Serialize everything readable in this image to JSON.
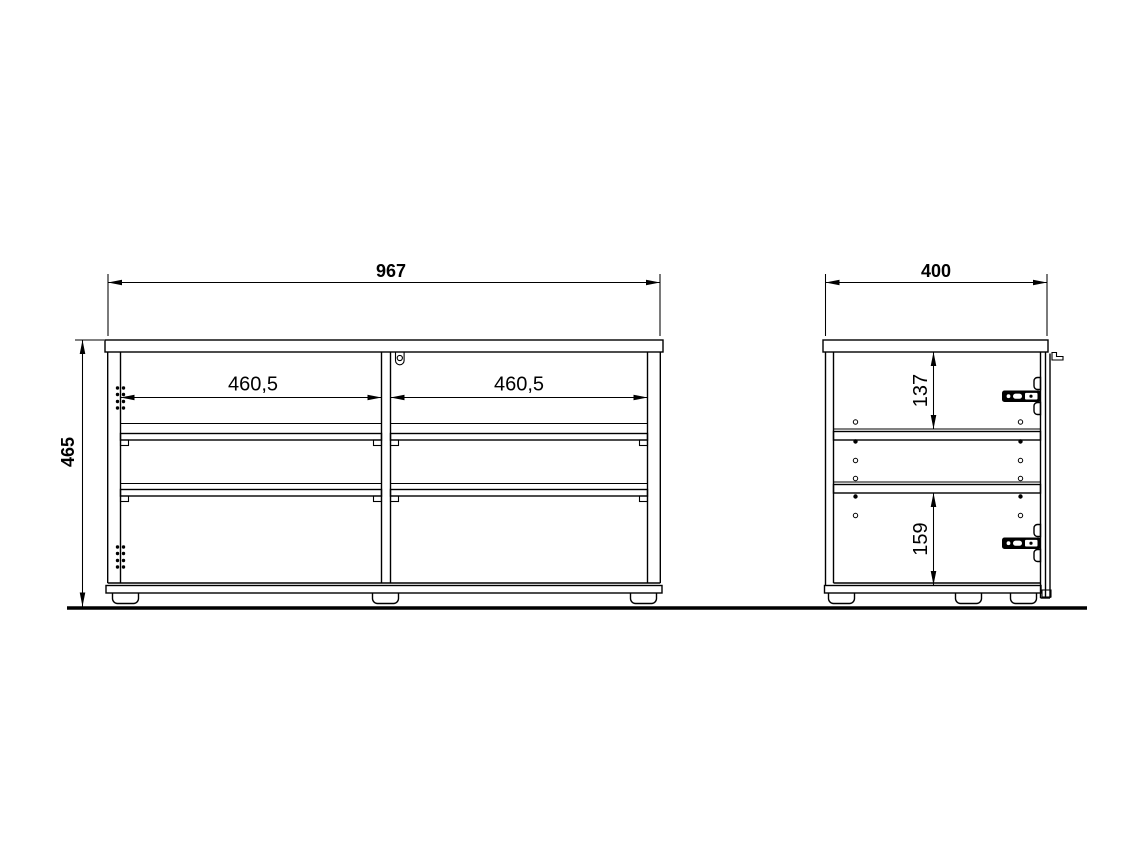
{
  "page": {
    "background_color": "#ffffff",
    "line_color": "#000000",
    "description": "Technical drawing of a cabinet: front elevation and side elevation with dimensions"
  },
  "views": {
    "front": {
      "dimensions": {
        "width": {
          "label": "967"
        },
        "height": {
          "label": "465"
        },
        "left_opening": {
          "label": "460,5"
        },
        "right_opening": {
          "label": "460,5"
        }
      }
    },
    "side": {
      "dimensions": {
        "depth": {
          "label": "400"
        },
        "upper_section": {
          "label": "137"
        },
        "lower_section": {
          "label": "159"
        }
      }
    }
  }
}
